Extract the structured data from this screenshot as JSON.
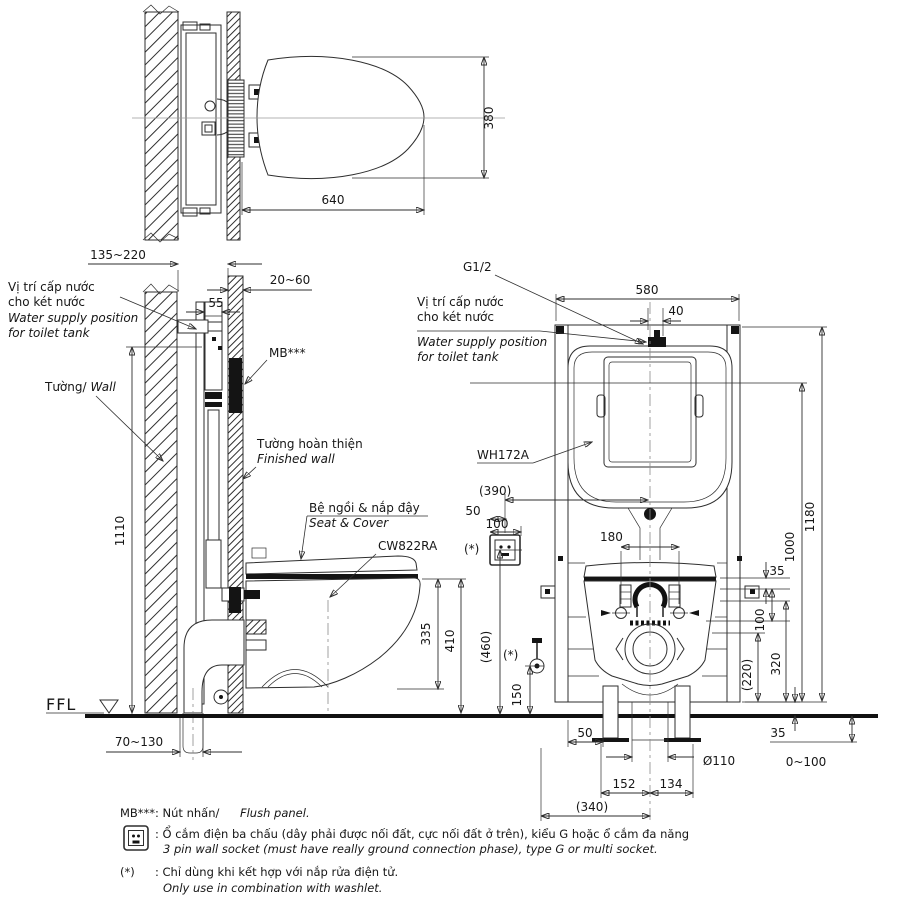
{
  "meta": {
    "bg": "#ffffff",
    "ink": "#2e2e2e",
    "dark": "#111111"
  },
  "top_view": {
    "dim_width": "640",
    "dim_depth": "380"
  },
  "side_view": {
    "dim_wall_cavity": "135~220",
    "dim_finished_wall": "20~60",
    "dim_supply": "55",
    "supply_label": {
      "vi1": "Vị trí cấp nước",
      "vi2": "cho két nước",
      "en1": "Water supply position",
      "en2": "for toilet tank"
    },
    "wall": {
      "vi": "Tường/",
      "en": "Wall"
    },
    "flush_panel_code": "MB***",
    "finished_wall": {
      "vi": "Tường hoàn thiện",
      "en": "Finished wall"
    },
    "seat_cover": {
      "vi": "Bệ ngồi & nắp đậy",
      "en": "Seat & Cover"
    },
    "bowl_model": "CW822RA",
    "dim_bowl_bottom": "335",
    "dim_rim_height": "410",
    "dim_height": "1110",
    "dim_drain": "70~130",
    "floor": "FFL"
  },
  "front_view": {
    "thread": "G1/2",
    "dim_width": "580",
    "dim_supply_offset": "40",
    "supply_label": {
      "vi1": "Vị trí cấp nước",
      "vi2": "cho két nước",
      "en1": "Water supply position",
      "en2": "for toilet tank"
    },
    "tank_model": "WH172A",
    "dim_socket_x": "(390)",
    "dim_socket_50": "50",
    "dim_socket_100": "100",
    "socket_star": "(*)",
    "dim_bolts": "180",
    "dim_h_total": "1180",
    "dim_h_1000": "1000",
    "dim_rim_35": "35",
    "dim_100": "100",
    "dim_320": "320",
    "dim_220": "(220)",
    "dim_socket_h": "(460)",
    "dim_valve_h": "150",
    "valve_star": "(*)",
    "dim_leg": "50",
    "dim_base": "35",
    "drain_dia": "Ø110",
    "dim_adjust": "0~100",
    "dim_152": "152",
    "dim_134": "134",
    "dim_340": "(340)"
  },
  "notes": {
    "mb_code": "MB***",
    "mb_vi": ": Nút nhấn/",
    "mb_en": "Flush panel.",
    "socket_vi": ": Ổ cắm điện ba chấu (dây phải được nối đất, cực nối đất ở trên), kiểu G hoặc ổ cắm đa năng",
    "socket_en": "3 pin wall socket (must have really ground connection phase), type G or multi socket.",
    "star_code": "(*)",
    "star_vi": ": Chỉ dùng khi kết hợp với nắp rửa điện tử.",
    "star_en": "Only use in combination with washlet."
  }
}
